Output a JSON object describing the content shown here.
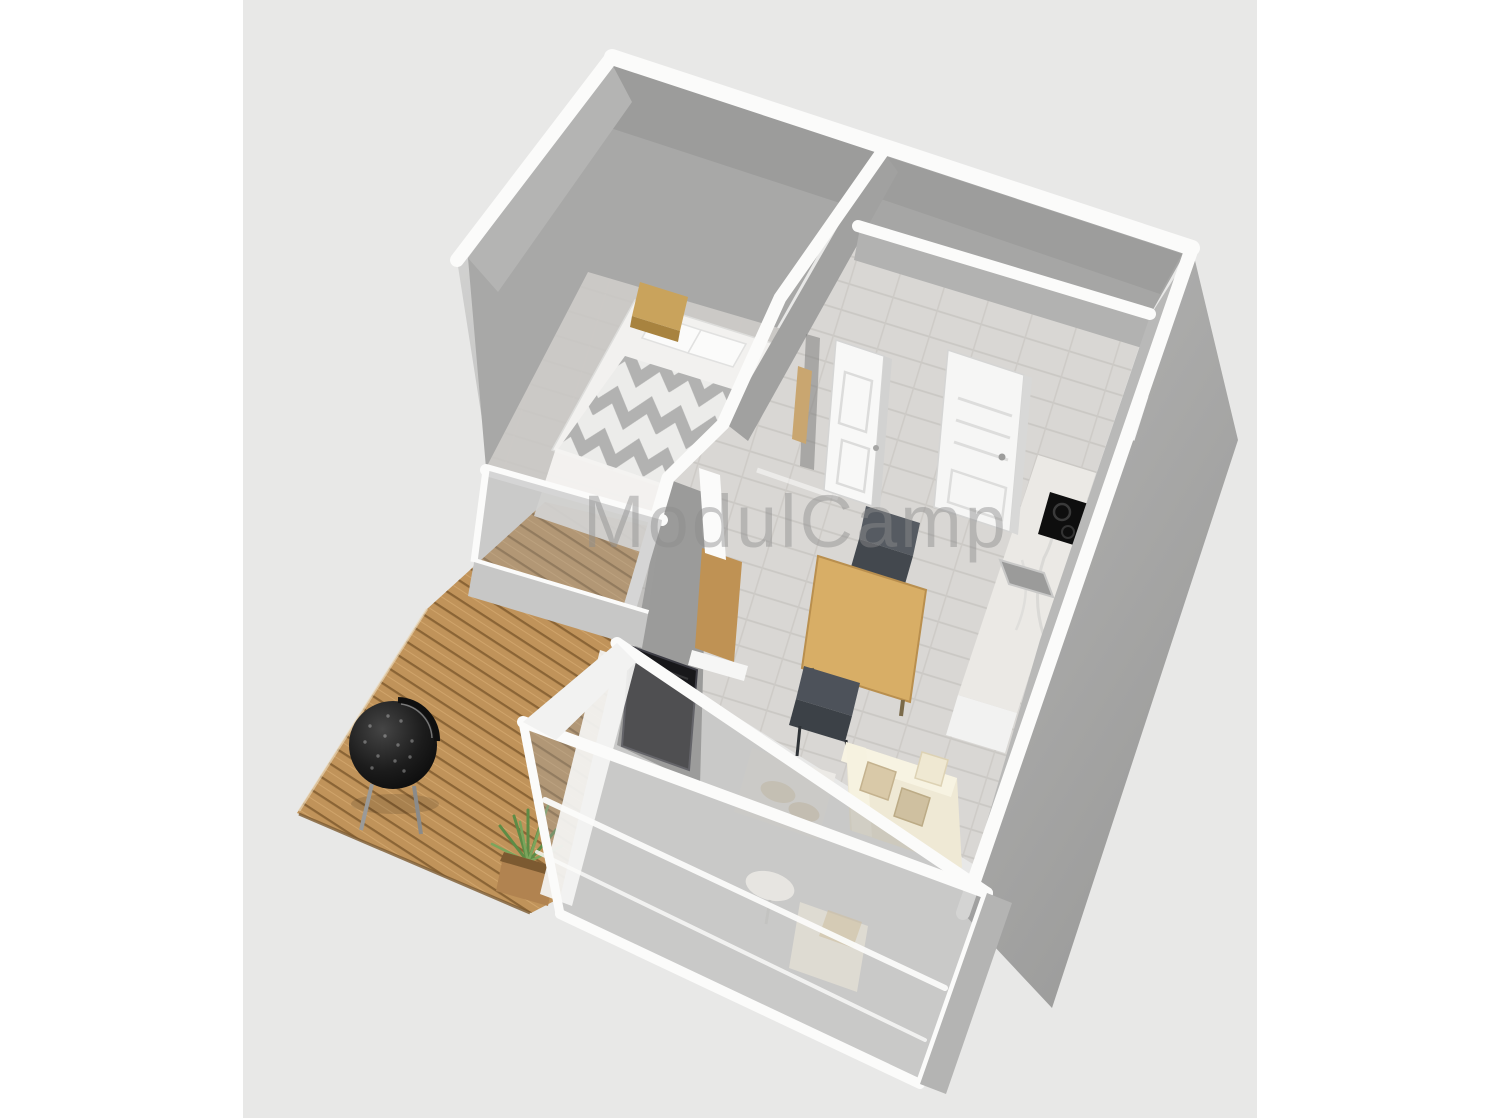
{
  "watermark": {
    "text": "ModulCamp",
    "color": "#8c8c8c"
  },
  "canvas": {
    "page_background": "#ffffff",
    "background": "#e8e8e7"
  },
  "palette": {
    "wall_top_white": "#fbfbfa",
    "wall_face_light": "#d5d5d4",
    "wall_face_mid": "#a9a9a8",
    "wall_face_dark": "#9b9b9a",
    "interior_floor": "#d9d7d4",
    "deck_wood": "#c0935a",
    "deck_plank_gap": "#8a6435",
    "bed_linen": "#f2f1ef",
    "bed_chevron_grey": "#b2b2b1",
    "nightstand_wood": "#c9a35c",
    "table_wood": "#d8ae66",
    "chair_dark": "#4e535a",
    "sofa_cream": "#efe9d5",
    "pillow_beige": "#d0c1a2",
    "tv_black": "#17171a",
    "counter_marble": "#ebe9e5",
    "cooktop_black": "#0e0e0e",
    "grill_black": "#141414",
    "plant_green": "#5e8c46",
    "glass_tint": "rgba(158,158,157,0.42)"
  },
  "scene": {
    "type": "3D floor plan render, bird's-eye perspective",
    "rooms": [
      "bedroom",
      "bathroom",
      "hallway",
      "kitchen",
      "living-dining-room",
      "wood-deck-terrace"
    ],
    "objects": [
      "double-bed-with-chevron-duvet",
      "wood-nightstand",
      "open-interior-door",
      "open-bathroom-door",
      "kitchen-counter-with-cooktop-and-sink",
      "dining-table",
      "dining-chairs",
      "wall-mounted-tv",
      "cream-sofa-with-pillows",
      "area-rug",
      "kettle-bbq-grill",
      "potted-plant",
      "glass-front-wall",
      "deck-planks"
    ]
  }
}
